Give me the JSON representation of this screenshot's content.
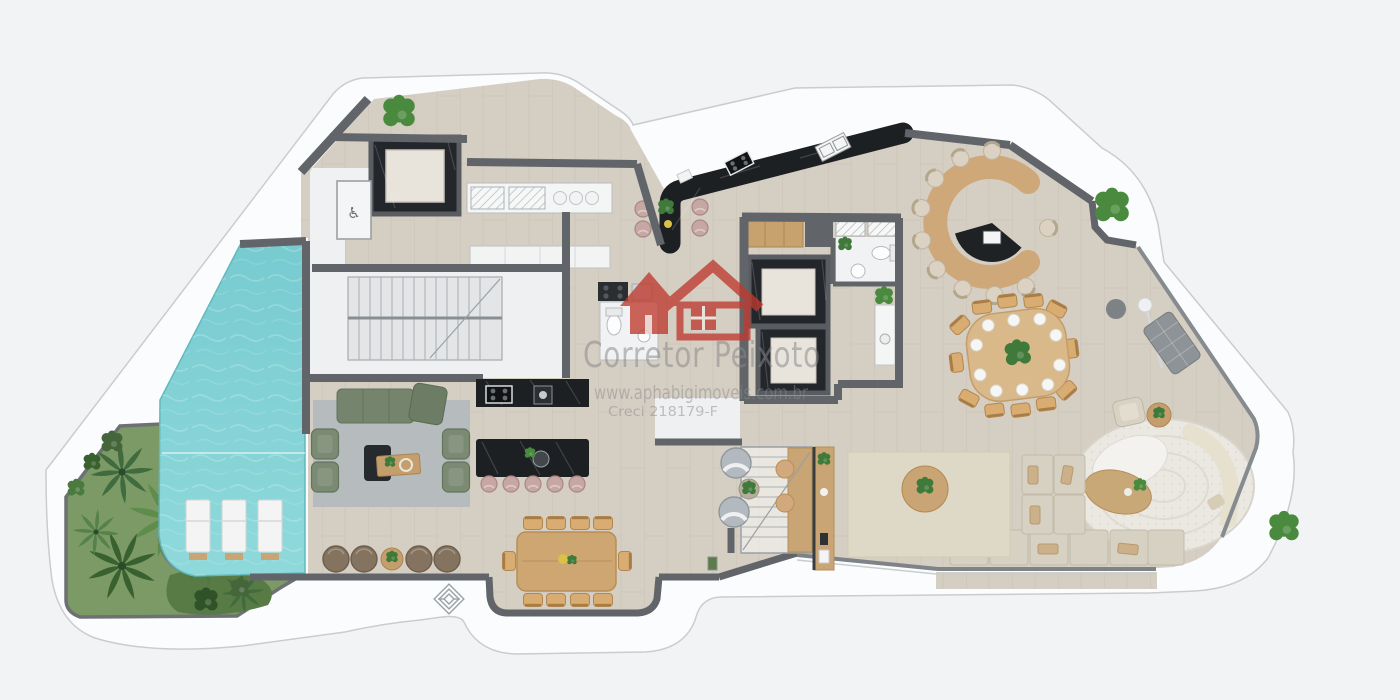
{
  "watermark": {
    "brand": "Corretor Peixoto",
    "website": "www.aphabigimoveis.com.br",
    "license": "Creci 218179-F",
    "logo": "red-double-house-icon"
  },
  "corner_logo": "layered-diamond-icon",
  "icons": {
    "accessible_glyph": "♿",
    "accessible_name": "wheelchair-accessible-icon"
  },
  "plan": {
    "type": "penthouse-floor-plan-top-view",
    "areas": [
      "swimming-pool",
      "sun-deck",
      "tropical-garden",
      "pool-lounge",
      "service-stairs",
      "service-elevator",
      "accessible-wc",
      "service-kitchen",
      "gourmet-black-bar",
      "social-elevators",
      "lavabo",
      "pantry",
      "c-shaped-meeting-table",
      "organic-dining-table",
      "terrace-lounge",
      "green-sofa-living",
      "kitchen-island",
      "long-dining-table",
      "internal-staircase",
      "bar-counter",
      "sectional-sofa-lounge",
      "round-rug-lounge",
      "curved-balcony"
    ],
    "counts": {
      "sun_loungers": 3,
      "island_stools": 5,
      "floor_poufs": 4,
      "c_table_chairs": 10,
      "organic_table_chairs": 12,
      "long_table_chairs": 10,
      "elevators": 3
    }
  },
  "palette": {
    "background": "#f2f3f5",
    "deck_white": "#fbfcfd",
    "wall_gray": "#61656a",
    "floor_wood": "#d5cec2",
    "pool_teal": "#7fd0d4",
    "garden_green": "#7c9a66",
    "palm_green": "#3f6b3f",
    "marble_black": "#1d2023",
    "furniture_wood": "#c9a475",
    "sofa_green": "#74836c",
    "cushion_beige": "#d7d1c4",
    "stool_pink": "#c7a7a3",
    "watermark_red": "#bf3a2f",
    "watermark_gray": "#8a8b8d"
  }
}
